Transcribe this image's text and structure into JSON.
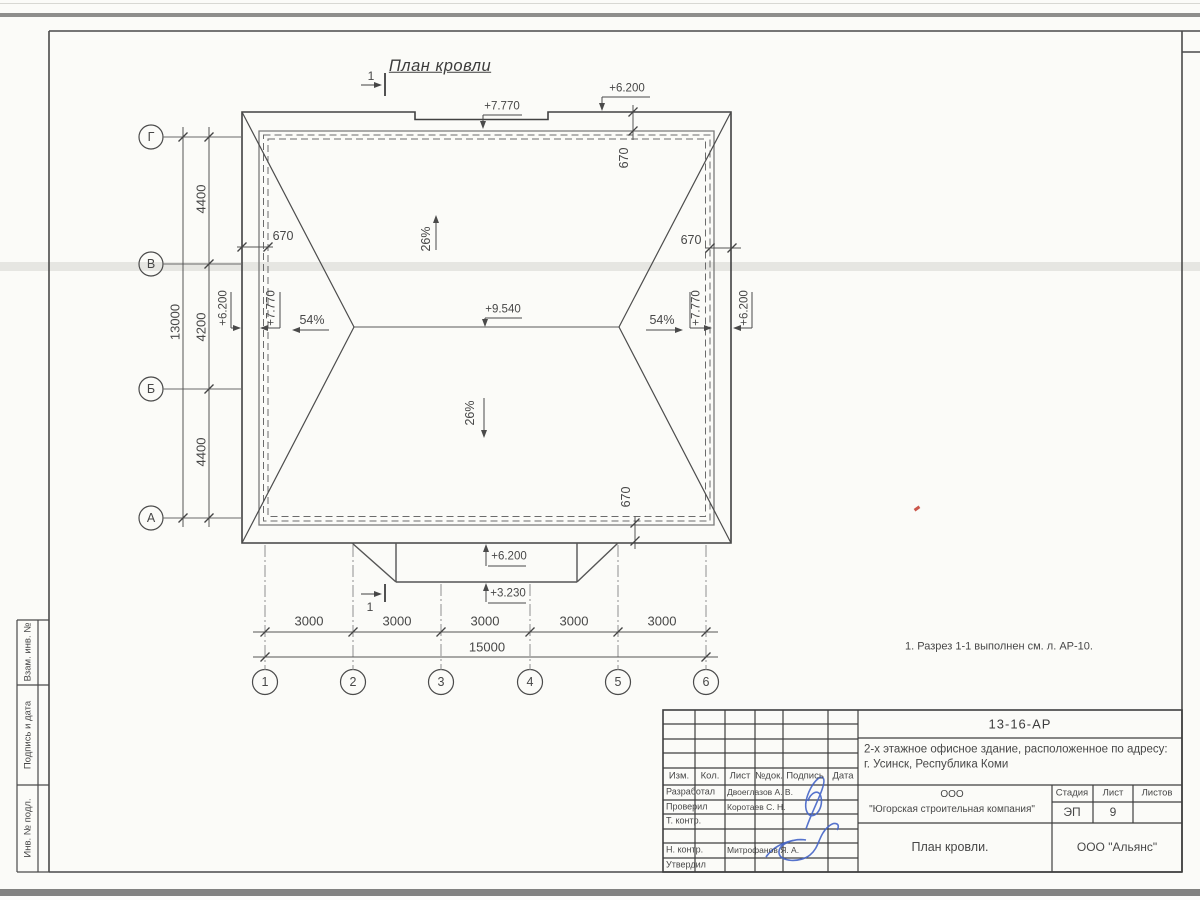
{
  "drawing": {
    "title": "План кровли",
    "note": "1. Разрез 1-1 выполнен см. л. АР-10.",
    "section_mark": "1",
    "elevations": {
      "main_roof_edge": "+7.770",
      "parapet_top": "+6.200",
      "ridge": "+9.540",
      "canopy_top": "+6.200",
      "canopy_edge": "+3.230"
    },
    "slopes": {
      "main": "26%",
      "end": "54%"
    },
    "overhang": "670"
  },
  "axes": {
    "rows": [
      "Г",
      "В",
      "Б",
      "А"
    ],
    "cols": [
      "1",
      "2",
      "3",
      "4",
      "5",
      "6"
    ]
  },
  "dims": {
    "left_segments": [
      "4400",
      "4200",
      "4400"
    ],
    "left_total": "13000",
    "bottom_segments": [
      "3000",
      "3000",
      "3000",
      "3000",
      "3000"
    ],
    "bottom_total": "15000"
  },
  "side_strip": {
    "labels": [
      "Взам. инв. №",
      "Подпись и дата",
      "Инв. № подл."
    ]
  },
  "title_block": {
    "doc_number": "13-16-АР",
    "object_line1": "2-х этажное офисное здание, расположенное по адресу:",
    "object_line2": "г. Усинск, Республика Коми",
    "company_line1": "ООО",
    "company_line2": "\"Югорская строительная компания\"",
    "stage_label": "Стадия",
    "sheet_label": "Лист",
    "sheets_label": "Листов",
    "stage": "ЭП",
    "sheet_no": "9",
    "drawing_name": "План кровли.",
    "contractor": "ООО \"Альянс\"",
    "header_cols": [
      "Изм.",
      "Кол.",
      "Лист",
      "№док.",
      "Подпись",
      "Дата"
    ],
    "roles": [
      {
        "label": "Разработал",
        "name": "Двоеглазов А. В."
      },
      {
        "label": "Проверил",
        "name": "Коротаев С. Н."
      },
      {
        "label": "Т. контр.",
        "name": ""
      },
      {
        "label": "",
        "name": ""
      },
      {
        "label": "Н. контр.",
        "name": "Митрофанов Я. А."
      },
      {
        "label": "Утвердил",
        "name": ""
      }
    ]
  }
}
